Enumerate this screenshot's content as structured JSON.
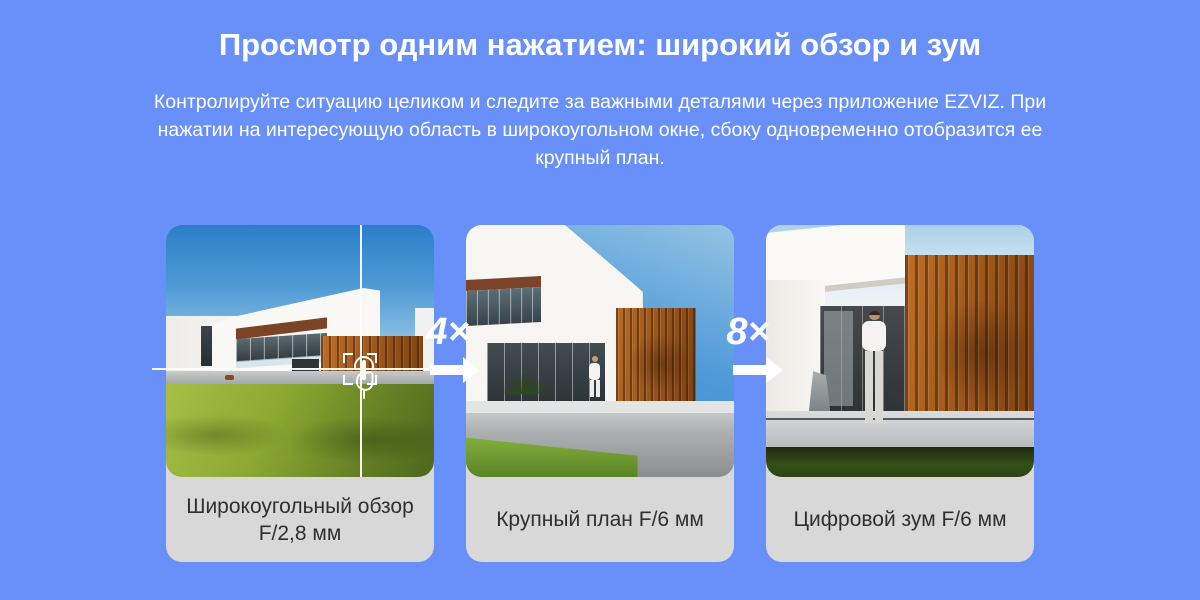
{
  "page": {
    "title": "Просмотр одним нажатием: широкий обзор и зум",
    "description": "Контролируйте ситуацию целиком и следите за важными деталями через приложение EZVIZ. При нажатии на интересующую область в широкоугольном окне, сбоку одновременно отобразится ее крупный план."
  },
  "cards": [
    {
      "label": "Широкоугольный обзор F/2,8 мм",
      "scene": "wide-angle-house-view"
    },
    {
      "label": "Крупный план F/6 мм",
      "scene": "close-up-house-view"
    },
    {
      "label": "Цифровой зум F/6 мм",
      "scene": "digital-zoom-house-view"
    }
  ],
  "zoom_steps": [
    {
      "factor": "4×",
      "icon": "arrow-right-icon"
    },
    {
      "factor": "8×",
      "icon": "arrow-right-icon"
    }
  ],
  "overlay": {
    "tap_icon": "tap-hand-icon",
    "focus_frame": "focus-frame",
    "crosshair": "crosshair-lines"
  },
  "colors": {
    "background": "#6890f8",
    "caption_background": "#d8d8d8",
    "caption_text": "#2f2f2f",
    "text": "#ffffff"
  }
}
